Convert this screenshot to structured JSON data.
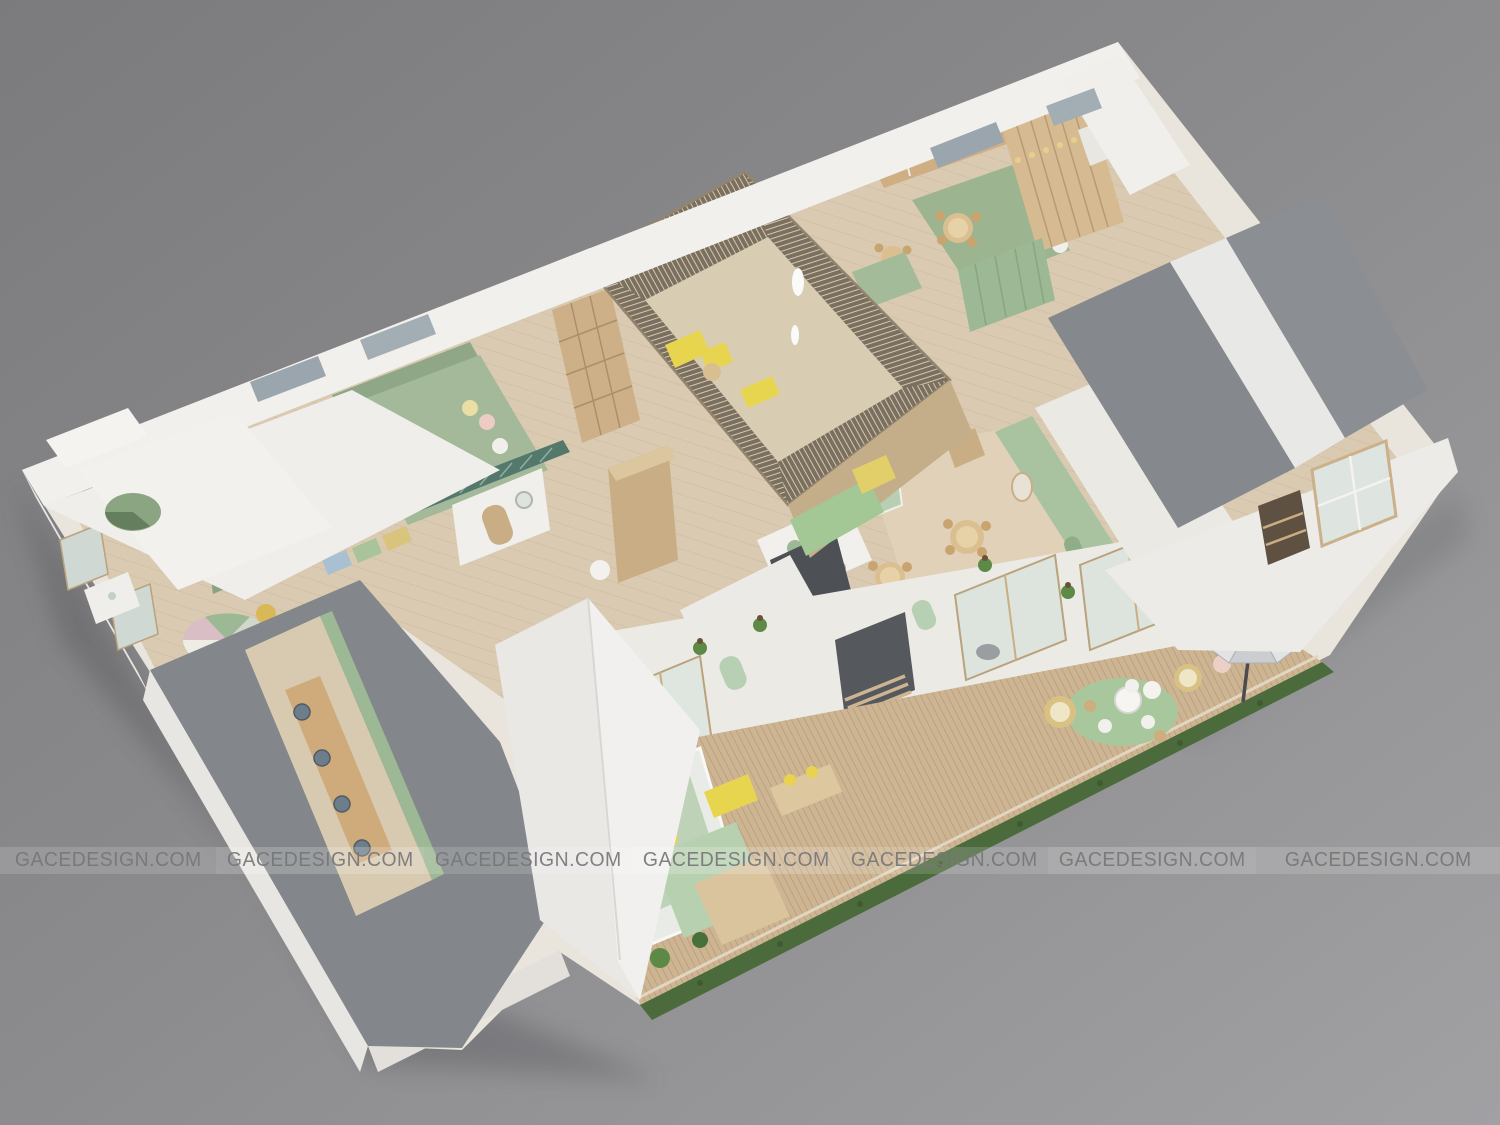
{
  "watermark": {
    "text": "GACEDESIGN.COM",
    "count": 7
  },
  "palette": {
    "background_top_left": "#7b7b7d",
    "background_bottom_right": "#a1a1a4",
    "roof_white": "#f1f0ed",
    "roof_gray": "#85888c",
    "wall_white": "#eceae6",
    "wood_floor": "#d9cab1",
    "deck_wood": "#cdb593",
    "pavilion_wood": "#8a7d6b",
    "slat_light": "#d8c7a8",
    "sage_green": "#9db894",
    "mint_green": "#bfd3ba",
    "accent_yellow": "#e8d24e",
    "hedge_green": "#4c6b3c",
    "umbrella_gray": "#d6d8da",
    "furniture_wood": "#d9bc8b",
    "office_chair_gray": "#6e7d8a",
    "dark_partition": "#55585c"
  }
}
